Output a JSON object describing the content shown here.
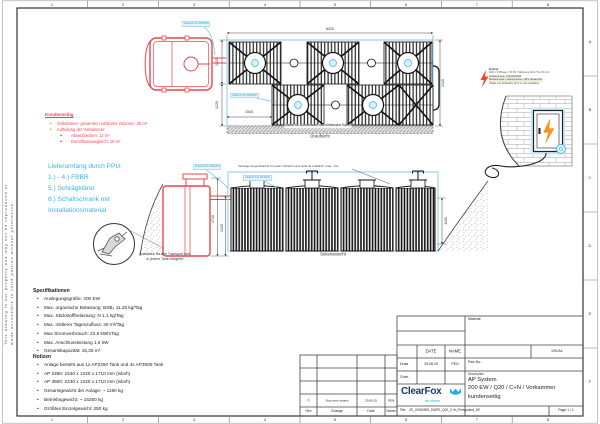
{
  "colors": {
    "customer_red": "#e8484d",
    "scope_cyan": "#35b8e0",
    "boundary_blue": "#9fd3ec",
    "brand_navy": "#16395f",
    "brand_cyan": "#29abe2"
  },
  "frame": {
    "top_numbers": [
      "1",
      "2",
      "3",
      "4",
      "5",
      "6",
      "7",
      "8"
    ],
    "bottom_numbers": [
      "1",
      "2",
      "3",
      "4",
      "5",
      "6",
      "7",
      "8"
    ],
    "right_letters": [
      "A",
      "B",
      "C",
      "D",
      "E",
      "F"
    ],
    "copyright_line1": "This drawing is our property and may not be reproduced or",
    "copyright_line2": "made accessible to third parties without permission."
  },
  "top_view": {
    "dim_width": "6420",
    "dim_right": "2440",
    "dim_left_upper": "1220",
    "dim_left_lower": "1220",
    "dim_bottom_left": "1540",
    "label_inlet": "Zulauf KG DN200",
    "label_outlet": "Ablauf KG DN160",
    "channel_note": "Kanal für Luftschlauch und elektrische Kabel",
    "caption": "Draufsicht"
  },
  "side_view": {
    "dim_height": "1710",
    "dim_inlet_depth": "1420",
    "dim_right": "1160",
    "label_inlet": "Zulauf KG DN200",
    "label_outlet": "Ablauf KG DN160",
    "extension_note": "Verlängerungsschächte für jeden Schacht sind optional erhältlich (max. 1m)",
    "crane_note_line1": "Kranösen für den Transport sind",
    "crane_note_line2": "in jedem Tank integriert",
    "caption": "Seitenansicht"
  },
  "customer": {
    "title": "Kundenseitig",
    "item1": "Vorkammer- gesamtes nutzbares Volumen: 30 m³",
    "item2": "Aufteilung der Vorkammer:",
    "item3": "Absetzbecken: 12 m³",
    "item4": "Durchflussausgleich: 18 m³"
  },
  "scope": {
    "line1": "Lieferumfang durch PPU:",
    "line2": "1.) - 4.) FBBR",
    "line3": "5.) Schrägklärer",
    "line4": "6.) Schaltschrank mit",
    "line5": "Installationsmaterial"
  },
  "electric": {
    "line1": "Elektrik:",
    "line2": "400V / 3 Phasen / 50 Hz / Sicherung 16 A / 5x 2,5 mm²",
    "line3": "Schaltschrank: 700x500x300",
    "line4": "Betriebsmittel: Luftkompressor, SPS, Bedienfeld",
    "line5": "(Kabel und Schläuche für 8 m sind enthalten)"
  },
  "specs": {
    "title": "Spezifikationen",
    "items": [
      "Auslegungsgröße: 200 EW",
      "Max. organische Belastung: BSB₅ 11,25 kg/Tag",
      "Max. Stickstoffbelastung: N 1,1 kg/Tag",
      "Max. mittlerer Tageszufluss: 30 m³/Tag",
      "Max Stromverbrauch: 22,5 kWh/Tag",
      "Max. Anschlussleistung 1,6 kW",
      "Gesamtkapazität: 16,25 m³"
    ],
    "notes_title": "Notizen",
    "notes": [
      "Anlage besteht aus 1x AP2250 Tank und 4x AP3500 Tank",
      "AP 2250: 1540 x 1220 x 1710 mm (lxbxh)",
      "AP 3500: 2430 x 1220 x 1710 mm (lxbxh)",
      "Gesamtgewicht der Anlage: ~ 1190 kg",
      "Betriebsgewicht: ~ 16250 kg",
      "Größtes Einzelgewicht: 250 kg"
    ]
  },
  "title_block": {
    "material_label": "Material",
    "date_header": "DATE",
    "name_header": "NAME",
    "draw_label": "Draw",
    "draw_date": "29.08.25",
    "draw_name": "PEN",
    "check_label": "Chek.",
    "din_label": "DIN  A4",
    "part_no_label": "Part-No.:",
    "description_label": "Description",
    "description_line1": "AP System",
    "description_line2": "200 EW / Q20 / C+N / Vorkammer",
    "description_line3": "kundenseitig",
    "logo_text": "ClearFox",
    "logo_tagline": "be clever",
    "file_label": "File:",
    "file_value": "ZE_20250909_200PE_Q20_C+N_Prebyclient_DE",
    "page_label": "Page 1 / 1",
    "rev": {
      "num": "0",
      "change": "Document created",
      "date": "29.08.25",
      "name": "PEN"
    },
    "rev_headers": {
      "rev": "Rev",
      "change": "Change",
      "date": "Date",
      "name": "Name"
    }
  }
}
